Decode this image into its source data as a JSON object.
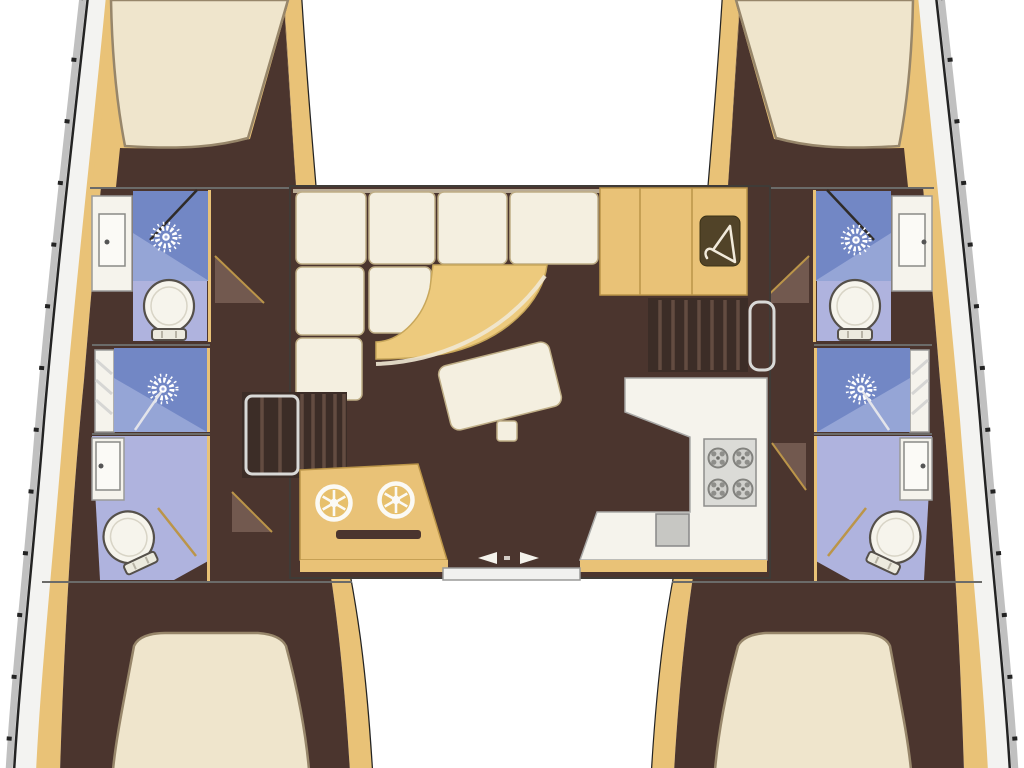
{
  "diagram": {
    "type": "boat-floor-plan",
    "view": "top-down",
    "vessel": "catamaran",
    "sections": {
      "port_hull": {
        "name": "port-hull",
        "rooms": [
          "bow-cabin-berth",
          "forward-bathroom",
          "midship-shower",
          "aft-bathroom",
          "aft-cabin-berth"
        ],
        "fixtures": [
          "double-berth",
          "vanity-sink",
          "shower-stall",
          "toilet",
          "shower-stall",
          "vanity-sink",
          "toilet",
          "double-berth"
        ]
      },
      "starboard_hull": {
        "name": "starboard-hull",
        "rooms": [
          "bow-cabin-berth",
          "forward-bathroom",
          "midship-shower",
          "aft-bathroom",
          "aft-cabin-berth"
        ],
        "fixtures": [
          "double-berth",
          "shower-stall",
          "vanity-sink",
          "toilet",
          "shower-stall",
          "vanity-sink",
          "toilet",
          "double-berth"
        ]
      },
      "saloon": {
        "name": "saloon",
        "rooms": [
          "lounge",
          "dining-area",
          "galley",
          "nav-console"
        ],
        "fixtures": [
          "l-shaped-sofa",
          "curved-table",
          "loose-bench",
          "wardrobe",
          "companionway-steps-port",
          "companionway-steps-starboard",
          "galley-counter",
          "four-burner-stove",
          "galley-sink",
          "console-dials",
          "sliding-door"
        ]
      }
    },
    "icons": [
      "shower-head-icon",
      "toilet-icon",
      "sink-icon",
      "burner-icon",
      "hanger-icon",
      "dial-icon",
      "slide-arrow-icon"
    ]
  },
  "colors": {
    "bg": "#ffffff",
    "shadow": "#c0c0c0",
    "line": "#232323",
    "deck": "#f3f3f1",
    "deck-line": "#9a9a98",
    "tan": "#e9c277",
    "tan-dark": "#bb9549",
    "brown": "#4b352e",
    "brown-light": "#72594f",
    "cream": "#efe5cc",
    "cream-line": "#97866a",
    "cushion": "#f4efe0",
    "cushion-line": "#bfae86",
    "table": "#edca7d",
    "blue": "#7287c5",
    "blue-light": "#95a5d6",
    "lavender": "#afb3de",
    "fixwhite": "#f5f3ec",
    "graysink": "#c7c7c3",
    "stove": "#dbdbd7",
    "steps": "#3c2d27",
    "steps-line": "#634c41",
    "wardrobe": "#514328",
    "wall": "#6b6b69",
    "stripe": "#d6d6d4"
  }
}
